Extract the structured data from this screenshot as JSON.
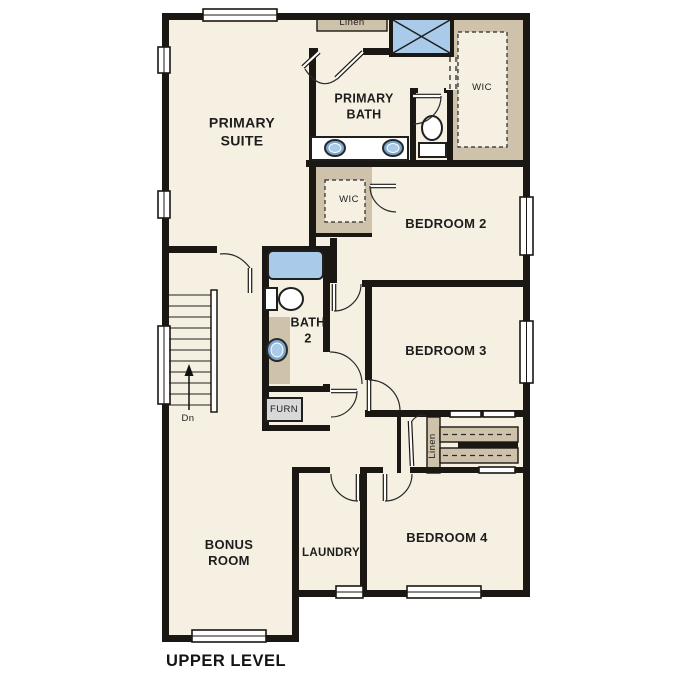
{
  "title": "UPPER LEVEL",
  "labels": {
    "primary_suite": "PRIMARY\nSUITE",
    "primary_bath": "PRIMARY\nBATH",
    "linen_top": "Linen",
    "wic_primary": "WIC",
    "wic_bedroom2": "WIC",
    "bedroom2": "BEDROOM 2",
    "bedroom3": "BEDROOM 3",
    "bedroom4": "BEDROOM 4",
    "bath2": "BATH\n2",
    "furnace": "FURN",
    "stairs_direction": "Dn",
    "linen_hall": "Linen",
    "bonus_room": "BONUS\nROOM",
    "laundry": "LAUNDRY"
  },
  "colors": {
    "wall": "#1b1712",
    "floor": "#f6f0e2",
    "closet": "#cec2ab",
    "fixture_blue": "#a9cbe9",
    "furn_gray": "#d8d8d8"
  },
  "fixtures": {
    "shower": "shower-with-x-symbol",
    "bathtub": "bathtub",
    "toilets": 2,
    "sinks": 3,
    "stairs": "down-to-lower-level"
  }
}
